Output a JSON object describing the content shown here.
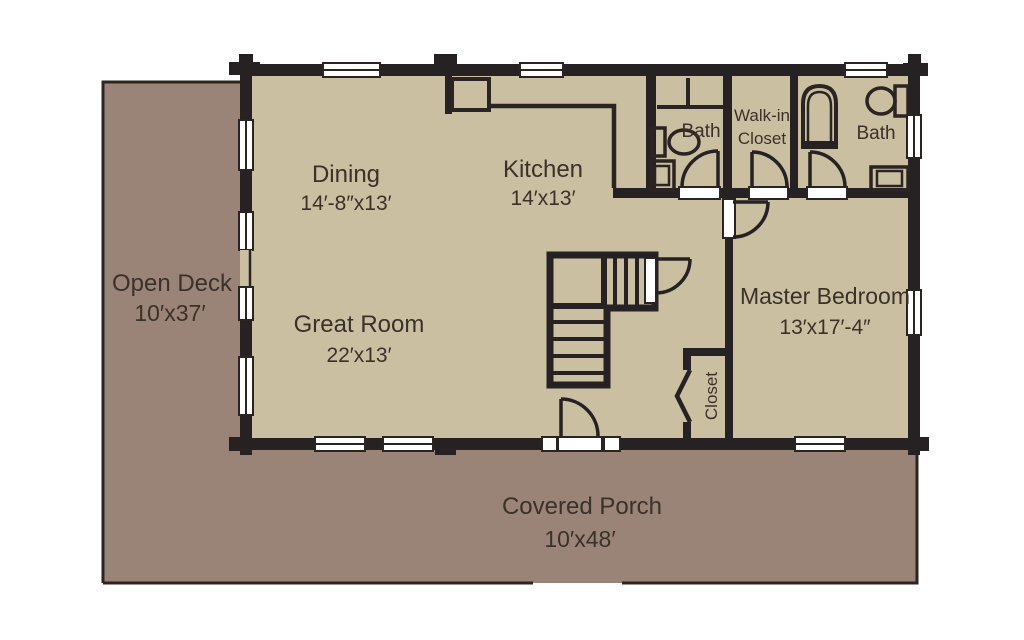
{
  "plan": {
    "type": "floor-plan",
    "labels": {
      "open_deck": {
        "name": "Open Deck",
        "dims": "10′x37′"
      },
      "covered_porch": {
        "name": "Covered Porch",
        "dims": "10′x48′"
      },
      "dining": {
        "name": "Dining",
        "dims": "14′-8″x13′"
      },
      "kitchen": {
        "name": "Kitchen",
        "dims": "14′x13′"
      },
      "great_room": {
        "name": "Great Room",
        "dims": "22′x13′"
      },
      "master_bedroom": {
        "name": "Master Bedroom",
        "dims": "13′x17′-4″"
      },
      "bath_left": {
        "name": "Bath"
      },
      "bath_right": {
        "name": "Bath"
      },
      "walk_in_closet": {
        "line1": "Walk-in",
        "line2": "Closet"
      },
      "closet": {
        "name": "Closet"
      }
    },
    "colors": {
      "background": "#ffffff",
      "deck_porch_fill": "#9a8478",
      "interior_fill": "#cbbfa2",
      "wall": "#262122",
      "thin_line": "#2b2423",
      "text": "#3a3129",
      "window_fill": "#ffffff"
    }
  }
}
